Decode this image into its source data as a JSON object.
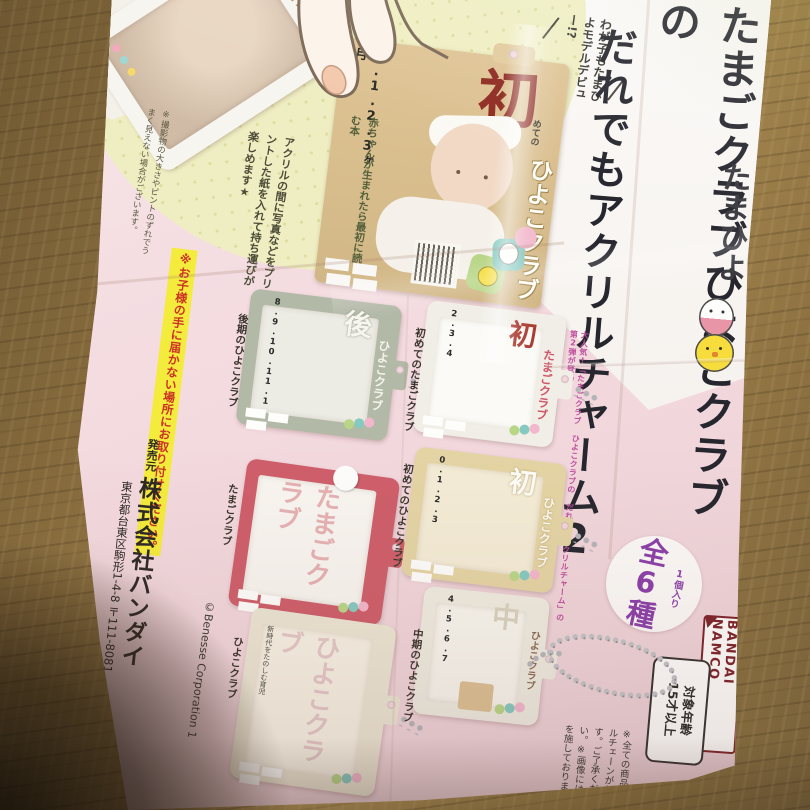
{
  "leaflet": {
    "brand": "たまひよ",
    "title": {
      "column1": "たまごクラブひよこクラブの",
      "column2": "だれでもアクリルチャーム2"
    },
    "promo": "大人気!「たまごクラブ ひよこクラブの だれでもアクリルチャーム」の第2弾が登場!",
    "pack_badge": {
      "sub": "1個入り",
      "main": "全6種"
    },
    "maker_logo": "BANDAI NAMCO",
    "age_rating": {
      "line1": "対象年齢",
      "line2": "15才以上"
    },
    "model_bubble": "わが子もたまひよモデルデビュー!?",
    "feature_note": "アクリルの間に写真などをプリントした紙を入れて持ち運びが楽しめます★",
    "photo_note": "※撮影物の大きさやピントのずれでうまく見えない場合がございます。",
    "safety_warning": "※お子様の手に届かない場所にお取り付けください。",
    "publisher": {
      "label": "発売元",
      "name": "株式会社バンダイ",
      "address": "東京都台東区駒形1-4-8 〒111-8081"
    },
    "copyright": "©Benesse Corporation 1",
    "product_notes": "※全ての商品にボールチェーンが付きます。ご了承ください。※画像には処理を施しております。",
    "demo_charm": {
      "logo": "ひよこクラブ"
    },
    "cover": {
      "months": "0.1.2.3ヶ月",
      "kanji": "初",
      "kanji_suffix": "めての",
      "logo": "ひよこクラブ",
      "tagline": "赤ちゃんが生まれたら最初に読む本"
    },
    "charms": [
      {
        "caption": "後期のひよこクラブ",
        "months": "8.9.10.11.1",
        "kanji": "後",
        "logo": "ひよこクラブ",
        "frame_color": "#b3b9a7"
      },
      {
        "caption": "初めてのたまごクラブ",
        "months": "2.3.4",
        "kanji": "初",
        "logo": "たまごクラブ",
        "frame_color": "#f1eee7"
      },
      {
        "caption": "たまごクラブ",
        "months": "",
        "kanji": "",
        "logo": "たまごクラブ",
        "frame_color": "#ce5e6a"
      },
      {
        "caption": "初めてのひよこクラブ",
        "months": "0.1.2.3",
        "kanji": "初",
        "logo": "ひよこクラブ",
        "frame_color": "#e4d4a4"
      },
      {
        "caption": "ひよこクラブ",
        "months": "",
        "kanji": "",
        "logo": "ひよこクラブ",
        "frame_color": "#ebe5d3",
        "side_text": "新時代をたのしむ育児"
      },
      {
        "caption": "中期のひよこクラブ",
        "months": "4.5.6.7",
        "kanji": "中",
        "logo": "ひよこクラブ",
        "frame_color": "#eeebe0"
      }
    ],
    "colors": {
      "paper_pink": "#f2d8dd",
      "paper_white": "#faf8f5",
      "pale_yellow": "#efeec2",
      "accent_pink": "#bf4f9e",
      "badge_purple": "#8a3fa8",
      "bandai_maroon": "#7c2228",
      "warning_yellow": "#f4ec3c",
      "warning_red": "#cc3326",
      "cover_tan": "#d8bd92",
      "wood_brown": "#8f7445"
    }
  }
}
